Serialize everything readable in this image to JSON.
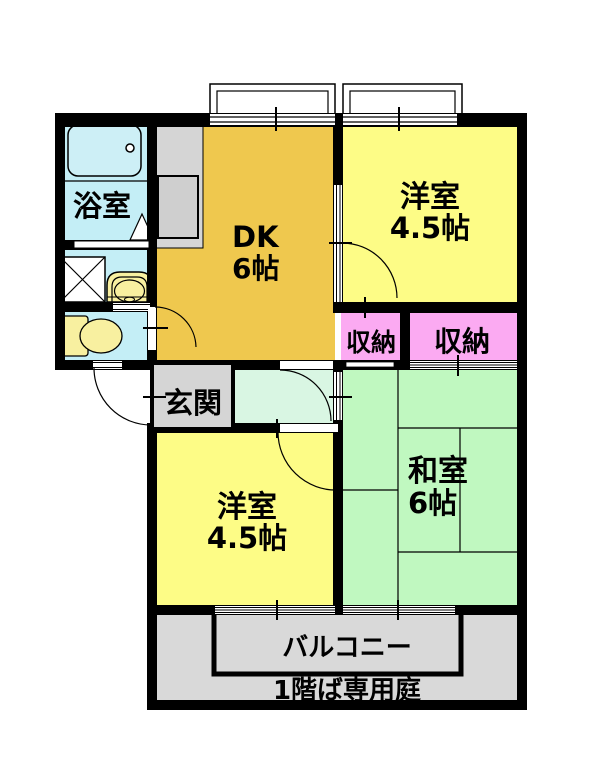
{
  "title": "apartment-floor-plan",
  "colors": {
    "wall": "#000000",
    "dk": "#efc84e",
    "western_room": "#fdfc86",
    "japanese_room": "#c0f8c0",
    "corridor": "#d9f6e3",
    "storage": "#fbaaf2",
    "wet_area": "#c4eef6",
    "fixture_yellow": "#f8f0a0",
    "gray_area": "#d5d5d5",
    "balcony_gray": "#d9d9d9",
    "tub": "#cdeff6",
    "sink_inner": "#cfcfcf"
  },
  "rooms": {
    "dk": {
      "label": "DK",
      "size": "6帖"
    },
    "western_upper": {
      "label": "洋室",
      "size": "4.5帖"
    },
    "western_lower": {
      "label": "洋室",
      "size": "4.5帖"
    },
    "japanese": {
      "label": "和室",
      "size": "6帖"
    },
    "bathroom": {
      "label": "浴室"
    },
    "entrance": {
      "label": "玄関"
    },
    "storage_small": {
      "label": "収納"
    },
    "storage_large": {
      "label": "収納"
    },
    "balcony": {
      "label": "バルコニー"
    },
    "garden_note": {
      "label": "1階ば専用庭"
    }
  }
}
